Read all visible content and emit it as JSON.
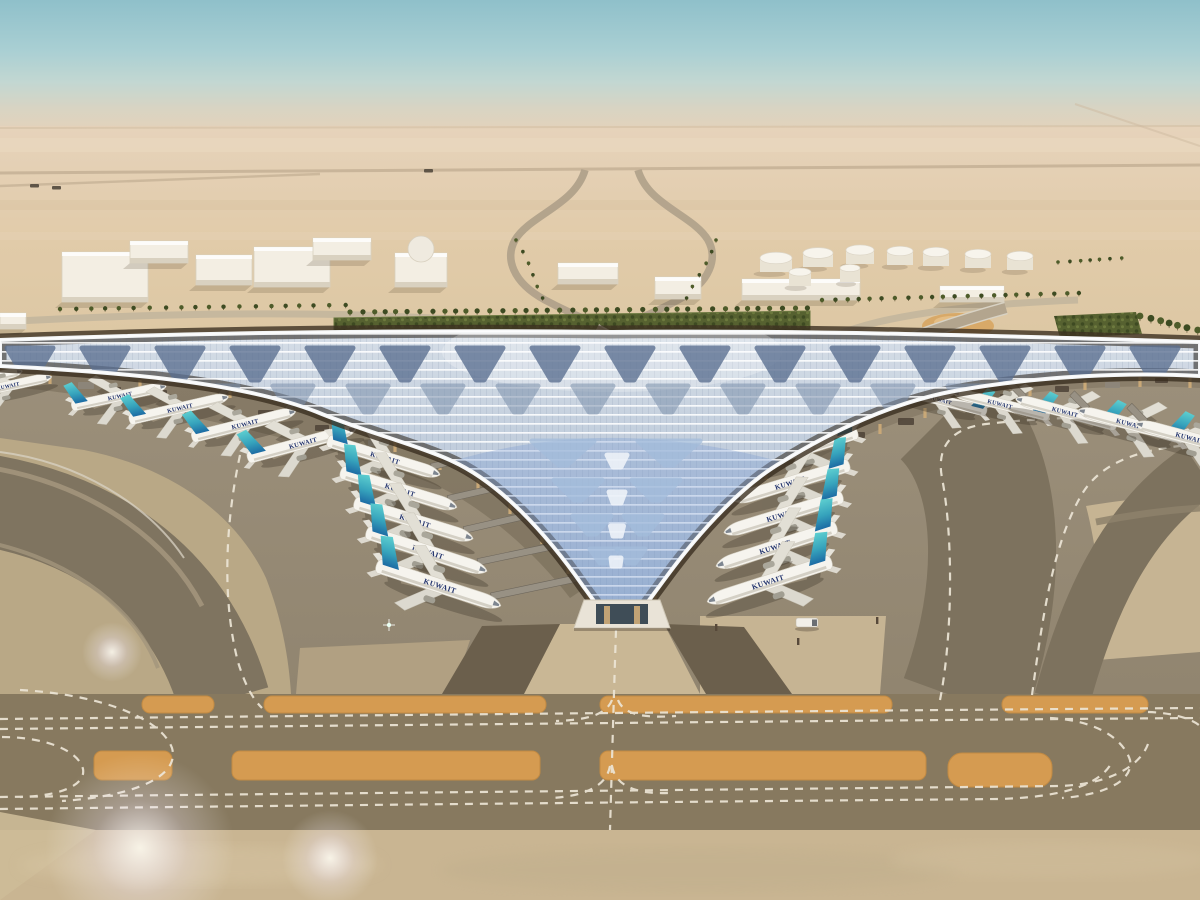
{
  "scene": {
    "type": "aerial-architectural-rendering",
    "subject": "Kuwait International Airport new terminal in desert landscape",
    "livery_text": "KUWAIT",
    "livery_text_arabic": "الكويتية",
    "aircraft_visible": 21,
    "terminal_shape": "three-winged trident with central V apex",
    "conditions": "hazy daylight"
  },
  "palette": {
    "sky_top": "#8fc0ca",
    "sky_horizon": "#e4d2ba",
    "desert": "#e1cba9",
    "vegetation": "#566130",
    "roof_light": "#eef1f4",
    "roof_panel": "#b7c7db",
    "feather_dark": "#5a6f90",
    "feather_mid": "#7c91ac",
    "feather_blue": "#a3bcdb",
    "column_tan": "#c9a877",
    "apron_gray": "#93876f",
    "taxiway_dark": "#87795f",
    "pavement_light": "#c8b593",
    "stripe_orange": "#d59b51",
    "marking_white": "#ece5d6",
    "fin_teal": "#58cbcd",
    "fin_blue": "#1d6ca4",
    "title_navy": "#24356e"
  },
  "background": {
    "buildings": [
      [
        0,
        313,
        26,
        16
      ],
      [
        62,
        252,
        86,
        50
      ],
      [
        130,
        241,
        58,
        22
      ],
      [
        196,
        255,
        56,
        30
      ],
      [
        254,
        247,
        76,
        40
      ],
      [
        313,
        238,
        58,
        22
      ],
      [
        395,
        253,
        52,
        34
      ],
      [
        558,
        263,
        60,
        21
      ],
      [
        655,
        277,
        46,
        22
      ],
      [
        742,
        279,
        118,
        21
      ],
      [
        940,
        286,
        64,
        16
      ]
    ],
    "dome": [
      421,
      249,
      13
    ],
    "fuel_tanks": [
      [
        776,
        258,
        16
      ],
      [
        818,
        253,
        15
      ],
      [
        860,
        250,
        14
      ],
      [
        900,
        251,
        13
      ],
      [
        936,
        252,
        13
      ],
      [
        978,
        254,
        13
      ],
      [
        1020,
        256,
        13
      ],
      [
        800,
        272,
        11
      ],
      [
        850,
        268,
        10
      ]
    ],
    "vehicles": [
      [
        30,
        184
      ],
      [
        52,
        186
      ],
      [
        424,
        169
      ]
    ],
    "gold_pavilion": [
      958,
      326
    ]
  },
  "ground": {
    "palm_rows": [
      [
        350,
        312,
        806,
        308,
        40,
        2.6
      ],
      [
        60,
        309,
        345,
        305,
        20,
        2.2
      ],
      [
        822,
        300,
        1078,
        293,
        22,
        2.2
      ],
      [
        1140,
        316,
        1198,
        330,
        7,
        3.4
      ],
      [
        516,
        240,
        544,
        298,
        6,
        1.8
      ],
      [
        716,
        240,
        688,
        298,
        6,
        1.8
      ],
      [
        1058,
        262,
        1122,
        258,
        7,
        1.8
      ]
    ]
  },
  "roof": {
    "feather_rows": [
      {
        "y": 348,
        "w": 46,
        "h": 32,
        "c": "#5a6f90",
        "o": 0.78,
        "cx": [
          30,
          105,
          180,
          255,
          330,
          405,
          480,
          555,
          630,
          705,
          780,
          855,
          930,
          1005,
          1080,
          1155
        ]
      },
      {
        "y": 386,
        "w": 40,
        "h": 26,
        "c": "#7c91ac",
        "o": 0.55,
        "cx": [
          68,
          143,
          218,
          293,
          368,
          443,
          518,
          593,
          668,
          743,
          818,
          893,
          968,
          1043,
          1118,
          1193
        ]
      }
    ],
    "v_feathers": [
      [
        563,
        441,
        62,
        24
      ],
      [
        669,
        441,
        62,
        24
      ],
      [
        578,
        480,
        48,
        20
      ],
      [
        656,
        480,
        48,
        20
      ],
      [
        592,
        516,
        38,
        18
      ],
      [
        643,
        516,
        38,
        18
      ],
      [
        604,
        549,
        28,
        14
      ],
      [
        631,
        549,
        28,
        14
      ]
    ],
    "spine": [
      [
        617,
        455,
        20,
        12
      ],
      [
        617,
        492,
        16,
        11
      ],
      [
        617,
        526,
        13,
        10
      ],
      [
        616,
        558,
        10,
        8
      ]
    ],
    "columns": [
      [
        50,
        374
      ],
      [
        140,
        380
      ],
      [
        230,
        388
      ],
      [
        290,
        406
      ],
      [
        340,
        424
      ],
      [
        395,
        442
      ],
      [
        440,
        460
      ],
      [
        478,
        480
      ],
      [
        510,
        504
      ],
      [
        542,
        534
      ],
      [
        568,
        564
      ],
      [
        588,
        590
      ],
      [
        655,
        590
      ],
      [
        673,
        562
      ],
      [
        693,
        536
      ],
      [
        715,
        512
      ],
      [
        739,
        490
      ],
      [
        766,
        470
      ],
      [
        800,
        456
      ],
      [
        838,
        440
      ],
      [
        880,
        424
      ],
      [
        925,
        408
      ],
      [
        975,
        396
      ],
      [
        1030,
        386
      ],
      [
        1085,
        380
      ],
      [
        1140,
        377
      ],
      [
        1190,
        378
      ]
    ]
  },
  "apron": {
    "gate_objects": [
      [
        78,
        382,
        16,
        7
      ],
      [
        110,
        387,
        11,
        5
      ],
      [
        152,
        390,
        15,
        6
      ],
      [
        208,
        398,
        13,
        6
      ],
      [
        258,
        410,
        16,
        7
      ],
      [
        315,
        425,
        14,
        6
      ],
      [
        368,
        440,
        13,
        6
      ],
      [
        850,
        432,
        15,
        6
      ],
      [
        898,
        418,
        16,
        7
      ],
      [
        948,
        404,
        14,
        6
      ],
      [
        1000,
        394,
        15,
        6
      ],
      [
        1055,
        386,
        14,
        6
      ],
      [
        1105,
        382,
        15,
        6
      ],
      [
        1155,
        378,
        13,
        5
      ]
    ]
  },
  "taxiways": {
    "orange_upper": {
      "y": 696,
      "h": 17,
      "segments": [
        [
          142,
          72
        ],
        [
          264,
          282
        ],
        [
          600,
          292
        ],
        [
          1002,
          146
        ]
      ]
    },
    "orange_lower": {
      "y": 751,
      "h": 29,
      "segments": [
        [
          94,
          78
        ],
        [
          232,
          308
        ],
        [
          600,
          326
        ]
      ]
    },
    "orange_pad": [
      948,
      753,
      104,
      34
    ]
  },
  "planes": [
    {
      "x": -20,
      "y": 380,
      "r": -12,
      "s": 0.68,
      "f": 0
    },
    {
      "x": 8,
      "y": 386,
      "r": -12,
      "s": 0.7,
      "f": 0
    },
    {
      "x": 120,
      "y": 396,
      "r": -12,
      "s": 0.74,
      "f": 0
    },
    {
      "x": 180,
      "y": 408,
      "r": -13,
      "s": 0.78,
      "f": 0
    },
    {
      "x": 245,
      "y": 424,
      "r": -14,
      "s": 0.82,
      "f": 0
    },
    {
      "x": 303,
      "y": 443,
      "r": -15,
      "s": 0.86,
      "f": 0
    },
    {
      "x": 385,
      "y": 458,
      "r": 17,
      "s": 0.9,
      "f": 0,
      "bl": 40
    },
    {
      "x": 400,
      "y": 490,
      "r": 17,
      "s": 0.93,
      "f": 0,
      "bl": 52
    },
    {
      "x": 415,
      "y": 521,
      "r": 17,
      "s": 0.95,
      "f": 0,
      "bl": 70
    },
    {
      "x": 428,
      "y": 552,
      "r": 18,
      "s": 0.97,
      "f": 0,
      "bl": 82
    },
    {
      "x": 440,
      "y": 586,
      "r": 18,
      "s": 1.0,
      "f": 0,
      "bl": 92
    },
    {
      "x": 800,
      "y": 450,
      "r": -17,
      "s": 0.9,
      "f": 1,
      "bl": 0
    },
    {
      "x": 790,
      "y": 483,
      "r": -17,
      "s": 0.93,
      "f": 1,
      "bl": 0
    },
    {
      "x": 782,
      "y": 515,
      "r": -17,
      "s": 0.95,
      "f": 1,
      "bl": 0
    },
    {
      "x": 775,
      "y": 547,
      "r": -18,
      "s": 0.97,
      "f": 1,
      "bl": 0
    },
    {
      "x": 768,
      "y": 582,
      "r": -18,
      "s": 1.0,
      "f": 1,
      "bl": 0
    },
    {
      "x": 940,
      "y": 400,
      "r": 14,
      "s": 0.72,
      "f": 1
    },
    {
      "x": 1000,
      "y": 404,
      "r": 14,
      "s": 0.76,
      "f": 1
    },
    {
      "x": 1065,
      "y": 412,
      "r": 15,
      "s": 0.8,
      "f": 1
    },
    {
      "x": 1130,
      "y": 424,
      "r": 15,
      "s": 0.84,
      "f": 1
    },
    {
      "x": 1190,
      "y": 438,
      "r": 15,
      "s": 0.88,
      "f": 1
    }
  ],
  "effects": {
    "flares": [
      [
        140,
        848,
        95
      ],
      [
        330,
        858,
        48
      ],
      [
        112,
        652,
        30
      ]
    ],
    "glint": [
      389,
      625
    ]
  }
}
